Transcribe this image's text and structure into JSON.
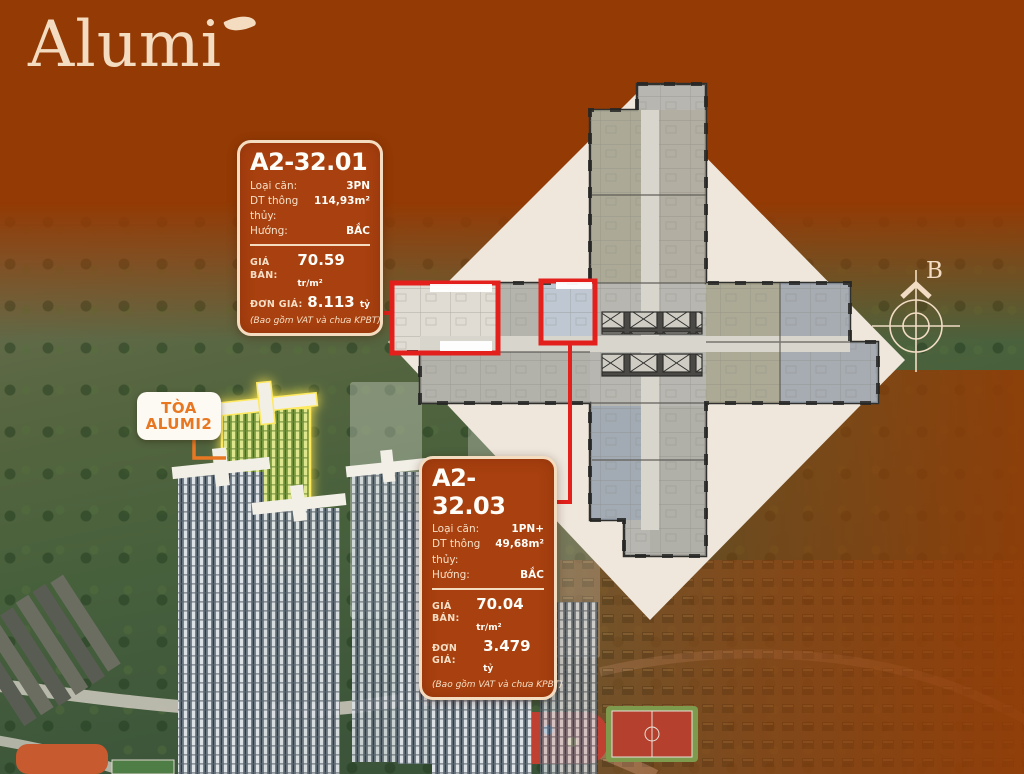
{
  "logo": {
    "text": "Alumi"
  },
  "tower_label": {
    "line1": "TÒA",
    "line2": "ALUMI2"
  },
  "compass": {
    "letter": "B"
  },
  "cards": [
    {
      "id": "A2-32.01",
      "rows": [
        {
          "label": "Loại căn:",
          "value": "3PN"
        },
        {
          "label": "DT thông thủy:",
          "value": "114,93m²"
        },
        {
          "label": "Hướng:",
          "value": "BẮC"
        }
      ],
      "price_rows": [
        {
          "label": "GIÁ BÁN:",
          "value": "70.59",
          "unit": "tr/m²"
        },
        {
          "label": "ĐƠN GIÁ:",
          "value": "8.113",
          "unit": "tỷ"
        }
      ],
      "note": "(Bao gồm VAT và chưa KPBT)"
    },
    {
      "id": "A2-32.03",
      "rows": [
        {
          "label": "Loại căn:",
          "value": "1PN+"
        },
        {
          "label": "DT thông thủy:",
          "value": "49,68m²"
        },
        {
          "label": "Hướng:",
          "value": "BẮC"
        }
      ],
      "price_rows": [
        {
          "label": "GIÁ BÁN:",
          "value": "70.04",
          "unit": "tr/m²"
        },
        {
          "label": "ĐƠN GIÁ:",
          "value": "3.479",
          "unit": "tỷ"
        }
      ],
      "note": "(Bao gồm VAT và chưa KPBT)"
    }
  ],
  "colors": {
    "background_rust": "#943a04",
    "card_bg": "#a8400f",
    "cream": "#f4dcc1",
    "highlight_red": "#e3201b",
    "diamond_cream": "#efe7dc",
    "accent_orange": "#e87722",
    "alumi2_glow_yellow": "#ffe74a"
  }
}
